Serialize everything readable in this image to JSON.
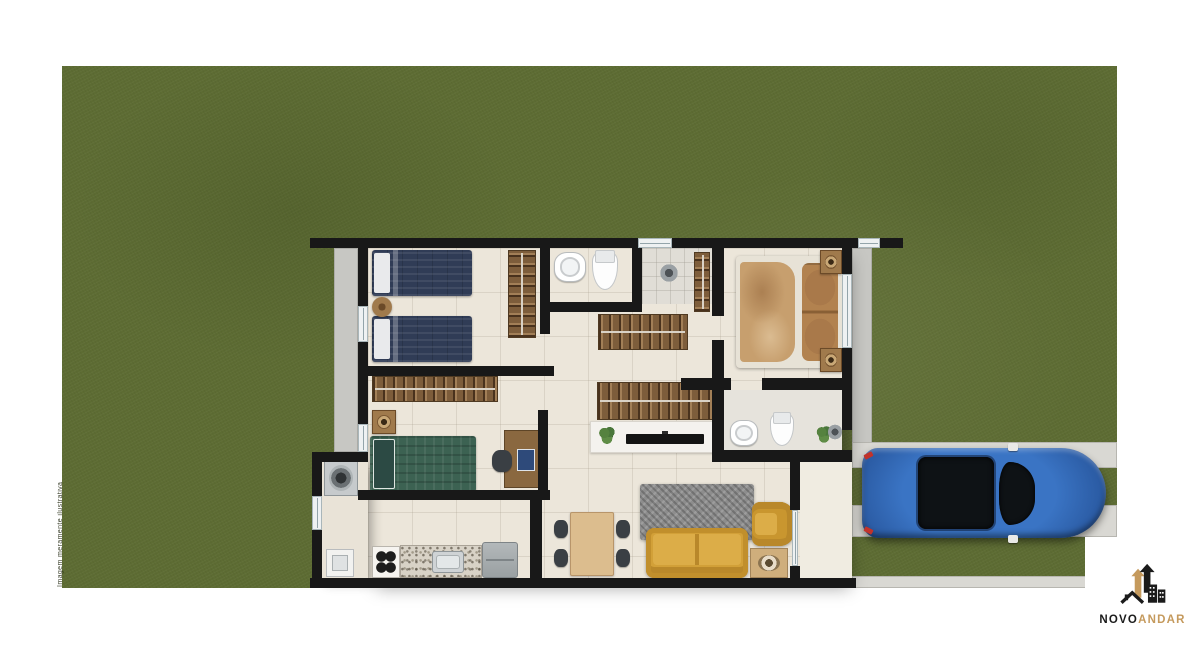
{
  "branding": {
    "name_primary": "NOVO",
    "name_secondary": "ANDAR",
    "colors": {
      "primary": "#1b1b1b",
      "secondary": "#c59a5d"
    }
  },
  "disclaimer": {
    "text": "Imagem meramente ilustrativa"
  },
  "palette": {
    "grass": "#5d6c33",
    "wall": "#181818",
    "floor_tile": "#ece6da",
    "sidewalk": "#c7c7c3",
    "driveway_track": "#d9d8d3",
    "sofa_yellow": "#d2a038",
    "car_blue": "#2a5aa2",
    "bed_navy": "#303c56",
    "bed_green": "#3c6252",
    "bed_master_tan": "#c79f6e",
    "wood": "#7d5d3b"
  },
  "floorplan": {
    "sidewalks": [
      {
        "name": "sidewalk-left",
        "rect": [
          334,
          248,
          24,
          204
        ]
      },
      {
        "name": "sidewalk-right",
        "rect": [
          852,
          248,
          20,
          200
        ]
      }
    ],
    "driveway": [
      {
        "name": "driveway-track-upper",
        "rect": [
          852,
          442,
          265,
          26
        ]
      },
      {
        "name": "driveway-track-lower",
        "rect": [
          852,
          505,
          265,
          32
        ]
      },
      {
        "name": "driveway-curb-bottom",
        "rect": [
          852,
          576,
          265,
          12
        ]
      }
    ],
    "floors": [
      {
        "name": "floor-main",
        "cls": "floor-main",
        "rect": [
          368,
          248,
          474,
          330
        ]
      },
      {
        "name": "floor-service",
        "cls": "floor-service",
        "rect": [
          322,
          462,
          46,
          116
        ]
      },
      {
        "name": "floor-porch",
        "cls": "floor-porch",
        "rect": [
          800,
          462,
          52,
          116
        ]
      },
      {
        "name": "floor-shower",
        "cls": "floor-shower",
        "rect": [
          642,
          248,
          70,
          56
        ]
      },
      {
        "name": "floor-ensuite",
        "cls": "floor-ensuite",
        "rect": [
          724,
          390,
          118,
          62
        ]
      }
    ],
    "furniture": [
      {
        "name": "twin-bed-a",
        "type": "bed-navy",
        "rect": [
          372,
          250,
          100,
          46
        ]
      },
      {
        "name": "twin-bed-b",
        "type": "bed-navy",
        "rect": [
          372,
          316,
          100,
          46
        ]
      },
      {
        "name": "bed1-round-table",
        "type": "round-wood",
        "rect": [
          372,
          297,
          20,
          20
        ]
      },
      {
        "name": "bed1-wardrobe",
        "type": "rack-v",
        "rect": [
          508,
          250,
          28,
          88
        ]
      },
      {
        "name": "bath1-sink",
        "type": "sink-round",
        "rect": [
          554,
          252,
          32,
          30
        ]
      },
      {
        "name": "bath1-toilet",
        "type": "toilet",
        "rect": [
          592,
          250,
          26,
          40
        ]
      },
      {
        "name": "shower1-head",
        "type": "shower",
        "rect": [
          660,
          264,
          18,
          18
        ]
      },
      {
        "name": "hall-wardrobe-vertical",
        "type": "rack-v",
        "rect": [
          694,
          252,
          16,
          60
        ]
      },
      {
        "name": "master-bed",
        "type": "bed-master",
        "rect": [
          736,
          256,
          106,
          112
        ]
      },
      {
        "name": "master-nightstand-a",
        "type": "nightstand",
        "rect": [
          820,
          250,
          22,
          24
        ]
      },
      {
        "name": "master-nightstand-b",
        "type": "nightstand",
        "rect": [
          820,
          348,
          22,
          24
        ]
      },
      {
        "name": "hall-closet-upper",
        "type": "rack-h",
        "rect": [
          598,
          314,
          90,
          36
        ]
      },
      {
        "name": "hall-closet-lower",
        "type": "rack-h",
        "rect": [
          597,
          382,
          116,
          38
        ]
      },
      {
        "name": "tv-console",
        "type": "console",
        "rect": [
          590,
          421,
          126,
          32
        ]
      },
      {
        "name": "console-plant",
        "type": "plant",
        "rect": [
          598,
          425,
          18,
          20
        ]
      },
      {
        "name": "tv",
        "type": "tv",
        "rect": [
          626,
          434,
          78,
          10
        ]
      },
      {
        "name": "bath2-sink",
        "type": "sink-round",
        "rect": [
          730,
          420,
          28,
          26
        ]
      },
      {
        "name": "bath2-toilet",
        "type": "toilet",
        "rect": [
          770,
          412,
          24,
          34
        ]
      },
      {
        "name": "bath2-plant",
        "type": "plant",
        "rect": [
          816,
          424,
          16,
          20
        ]
      },
      {
        "name": "shower2-head",
        "type": "shower",
        "rect": [
          828,
          424,
          14,
          16
        ]
      },
      {
        "name": "single-bed-green",
        "type": "bed-green",
        "rect": [
          370,
          436,
          106,
          56
        ]
      },
      {
        "name": "bed3-nightstand",
        "type": "nightstand",
        "rect": [
          372,
          410,
          24,
          24
        ]
      },
      {
        "name": "bed3-closet",
        "type": "rack-h",
        "rect": [
          372,
          376,
          126,
          26
        ]
      },
      {
        "name": "desk",
        "type": "desk",
        "rect": [
          504,
          430,
          36,
          58
        ]
      },
      {
        "name": "desk-chair",
        "type": "chair-dark",
        "rect": [
          492,
          450,
          20,
          22
        ]
      },
      {
        "name": "stove",
        "type": "stove",
        "rect": [
          372,
          546,
          28,
          32
        ]
      },
      {
        "name": "kitchen-counter",
        "type": "counter",
        "rect": [
          400,
          545,
          82,
          33
        ]
      },
      {
        "name": "kitchen-sink",
        "type": "sink-steel",
        "rect": [
          432,
          551,
          32,
          22
        ]
      },
      {
        "name": "fridge",
        "type": "fridge",
        "rect": [
          482,
          542,
          36,
          36
        ]
      },
      {
        "name": "washing-machine",
        "type": "washer",
        "rect": [
          324,
          460,
          34,
          36
        ]
      },
      {
        "name": "laundry-tank",
        "type": "laundry",
        "rect": [
          326,
          549,
          28,
          28
        ]
      },
      {
        "name": "dining-table",
        "type": "table-wood",
        "rect": [
          570,
          512,
          44,
          64
        ]
      },
      {
        "name": "dining-chair-1",
        "type": "chair-dark",
        "rect": [
          554,
          520,
          14,
          18
        ]
      },
      {
        "name": "dining-chair-2",
        "type": "chair-dark",
        "rect": [
          554,
          549,
          14,
          18
        ]
      },
      {
        "name": "dining-chair-3",
        "type": "chair-dark",
        "rect": [
          616,
          520,
          14,
          18
        ]
      },
      {
        "name": "dining-chair-4",
        "type": "chair-dark",
        "rect": [
          616,
          549,
          14,
          18
        ]
      },
      {
        "name": "living-rug",
        "type": "rug",
        "rect": [
          640,
          484,
          114,
          56
        ]
      },
      {
        "name": "sofa",
        "type": "sofa",
        "rect": [
          646,
          528,
          102,
          50
        ]
      },
      {
        "name": "armchair",
        "type": "armchair",
        "rect": [
          752,
          502,
          42,
          44
        ]
      },
      {
        "name": "side-table-lamp",
        "type": "side-table",
        "rect": [
          750,
          548,
          38,
          30
        ]
      },
      {
        "name": "car",
        "type": "car",
        "rect": [
          862,
          448,
          244,
          90
        ]
      }
    ],
    "walls": [
      {
        "name": "wall-top",
        "rect": [
          310,
          238,
          593,
          10
        ]
      },
      {
        "name": "wall-left",
        "rect": [
          358,
          238,
          10,
          224
        ]
      },
      {
        "name": "wall-service-left",
        "rect": [
          312,
          452,
          10,
          136
        ]
      },
      {
        "name": "wall-service-top",
        "rect": [
          312,
          452,
          56,
          10
        ]
      },
      {
        "name": "wall-bottom",
        "rect": [
          310,
          578,
          546,
          10
        ]
      },
      {
        "name": "wall-right",
        "rect": [
          842,
          248,
          10,
          182
        ]
      },
      {
        "name": "wall-bed1-bath1",
        "rect": [
          540,
          248,
          10,
          86
        ]
      },
      {
        "name": "wall-bed1-bottom",
        "rect": [
          368,
          366,
          186,
          10
        ]
      },
      {
        "name": "wall-bed3-right",
        "rect": [
          538,
          410,
          10,
          90
        ]
      },
      {
        "name": "wall-bed3-bottom",
        "rect": [
          358,
          490,
          192,
          10
        ]
      },
      {
        "name": "wall-kitchen-divider",
        "rect": [
          530,
          500,
          12,
          78
        ]
      },
      {
        "name": "wall-bath1-bottom",
        "rect": [
          550,
          302,
          92,
          10
        ]
      },
      {
        "name": "wall-bath1-right",
        "rect": [
          632,
          248,
          10,
          62
        ]
      },
      {
        "name": "wall-master-left-up",
        "rect": [
          712,
          248,
          12,
          68
        ]
      },
      {
        "name": "wall-master-left-low",
        "rect": [
          712,
          340,
          12,
          122
        ]
      },
      {
        "name": "wall-master-bottom-a",
        "rect": [
          681,
          378,
          50,
          12
        ]
      },
      {
        "name": "wall-master-bottom-b",
        "rect": [
          762,
          378,
          80,
          12
        ]
      },
      {
        "name": "wall-bath2-bottom",
        "rect": [
          712,
          450,
          140,
          12
        ]
      },
      {
        "name": "wall-porch-door-up",
        "rect": [
          790,
          462,
          10,
          48
        ]
      },
      {
        "name": "wall-porch-door-low",
        "rect": [
          790,
          566,
          10,
          12
        ]
      }
    ],
    "windows": [
      {
        "name": "window-top-a",
        "rect": [
          638,
          238,
          34,
          10
        ]
      },
      {
        "name": "window-top-b",
        "rect": [
          858,
          238,
          22,
          10
        ]
      },
      {
        "name": "window-left-a",
        "rect": [
          358,
          306,
          10,
          36
        ]
      },
      {
        "name": "window-left-b",
        "rect": [
          358,
          424,
          10,
          28
        ]
      },
      {
        "name": "window-right-a",
        "rect": [
          842,
          274,
          10,
          74
        ]
      },
      {
        "name": "window-service",
        "rect": [
          312,
          496,
          10,
          34
        ]
      },
      {
        "name": "sliding-door-glass",
        "rect": [
          792,
          510,
          6,
          56
        ]
      }
    ]
  }
}
